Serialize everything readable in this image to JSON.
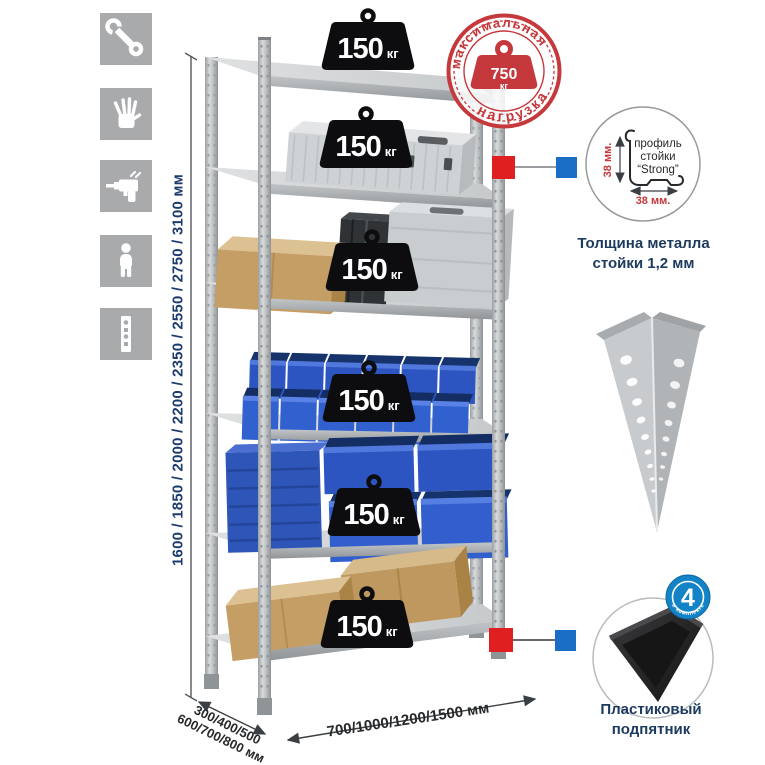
{
  "panel_icons": {
    "items": [
      {
        "name": "wrench"
      },
      {
        "name": "work-gloves"
      },
      {
        "name": "drill"
      },
      {
        "name": "assembler-person"
      },
      {
        "name": "perforated-post"
      }
    ]
  },
  "rack": {
    "shelves": [
      {
        "load_value": "150",
        "load_unit": "кг"
      },
      {
        "load_value": "150",
        "load_unit": "кг"
      },
      {
        "load_value": "150",
        "load_unit": "кг"
      },
      {
        "load_value": "150",
        "load_unit": "кг"
      },
      {
        "load_value": "150",
        "load_unit": "кг"
      },
      {
        "load_value": "150",
        "load_unit": "кг"
      }
    ]
  },
  "stamp": {
    "text_top": "максимальная",
    "text_bottom": "нагрузка",
    "weight_value": "750",
    "weight_unit": "кг"
  },
  "dimensions": {
    "height": "1600 / 1850 / 2000 / 2200 / 2350 / 2550 / 2750 / 3100 мм",
    "depth_line1": "300/400/500",
    "depth_line2": "600/700/800 мм",
    "width": "700/1000/1200/1500 мм"
  },
  "profile_detail": {
    "label_line1": "профиль",
    "label_line2": "стойки",
    "label_line3": "“Strong”",
    "dim_vertical": "38 мм.",
    "dim_horizontal": "38 мм.",
    "caption": "Толщина металла стойки 1,2 мм"
  },
  "foot_detail": {
    "badge_value": "4",
    "badge_arc_text": "в комплекте",
    "caption": "Пластиковый подпятник"
  },
  "colors": {
    "stamp_red": "#c5393c",
    "marker_red": "#e02020",
    "marker_blue": "#1a6ec5",
    "dimension_text": "#1d3c6e",
    "bin_blue": "#2c55c2",
    "metal_gray": "#c7cacc"
  }
}
